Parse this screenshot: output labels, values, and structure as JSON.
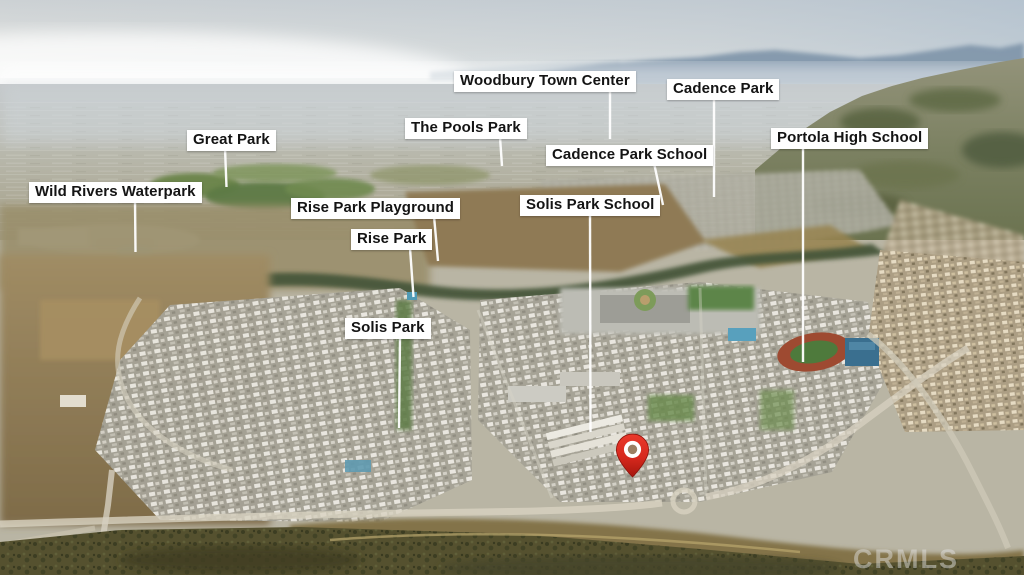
{
  "labels": [
    {
      "id": "wild-rivers-waterpark",
      "text": "Wild Rivers Waterpark"
    },
    {
      "id": "great-park",
      "text": "Great Park"
    },
    {
      "id": "the-pools-park",
      "text": "The Pools Park"
    },
    {
      "id": "woodbury-town-center",
      "text": "Woodbury Town Center"
    },
    {
      "id": "cadence-park",
      "text": "Cadence Park"
    },
    {
      "id": "cadence-park-school",
      "text": "Cadence Park School"
    },
    {
      "id": "portola-high-school",
      "text": "Portola High School"
    },
    {
      "id": "solis-park-school",
      "text": "Solis Park School"
    },
    {
      "id": "rise-park-playground",
      "text": "Rise Park Playground"
    },
    {
      "id": "rise-park",
      "text": "Rise Park"
    },
    {
      "id": "solis-park",
      "text": "Solis Park"
    }
  ],
  "pin": {
    "meaning": "property-location",
    "color": "#d6281d"
  },
  "watermark": {
    "text": "CRMLS"
  },
  "colors": {
    "label_background": "#ffffff",
    "label_text": "#141414",
    "leader_line": "#ffffff",
    "pin_red": "#d6281d"
  }
}
